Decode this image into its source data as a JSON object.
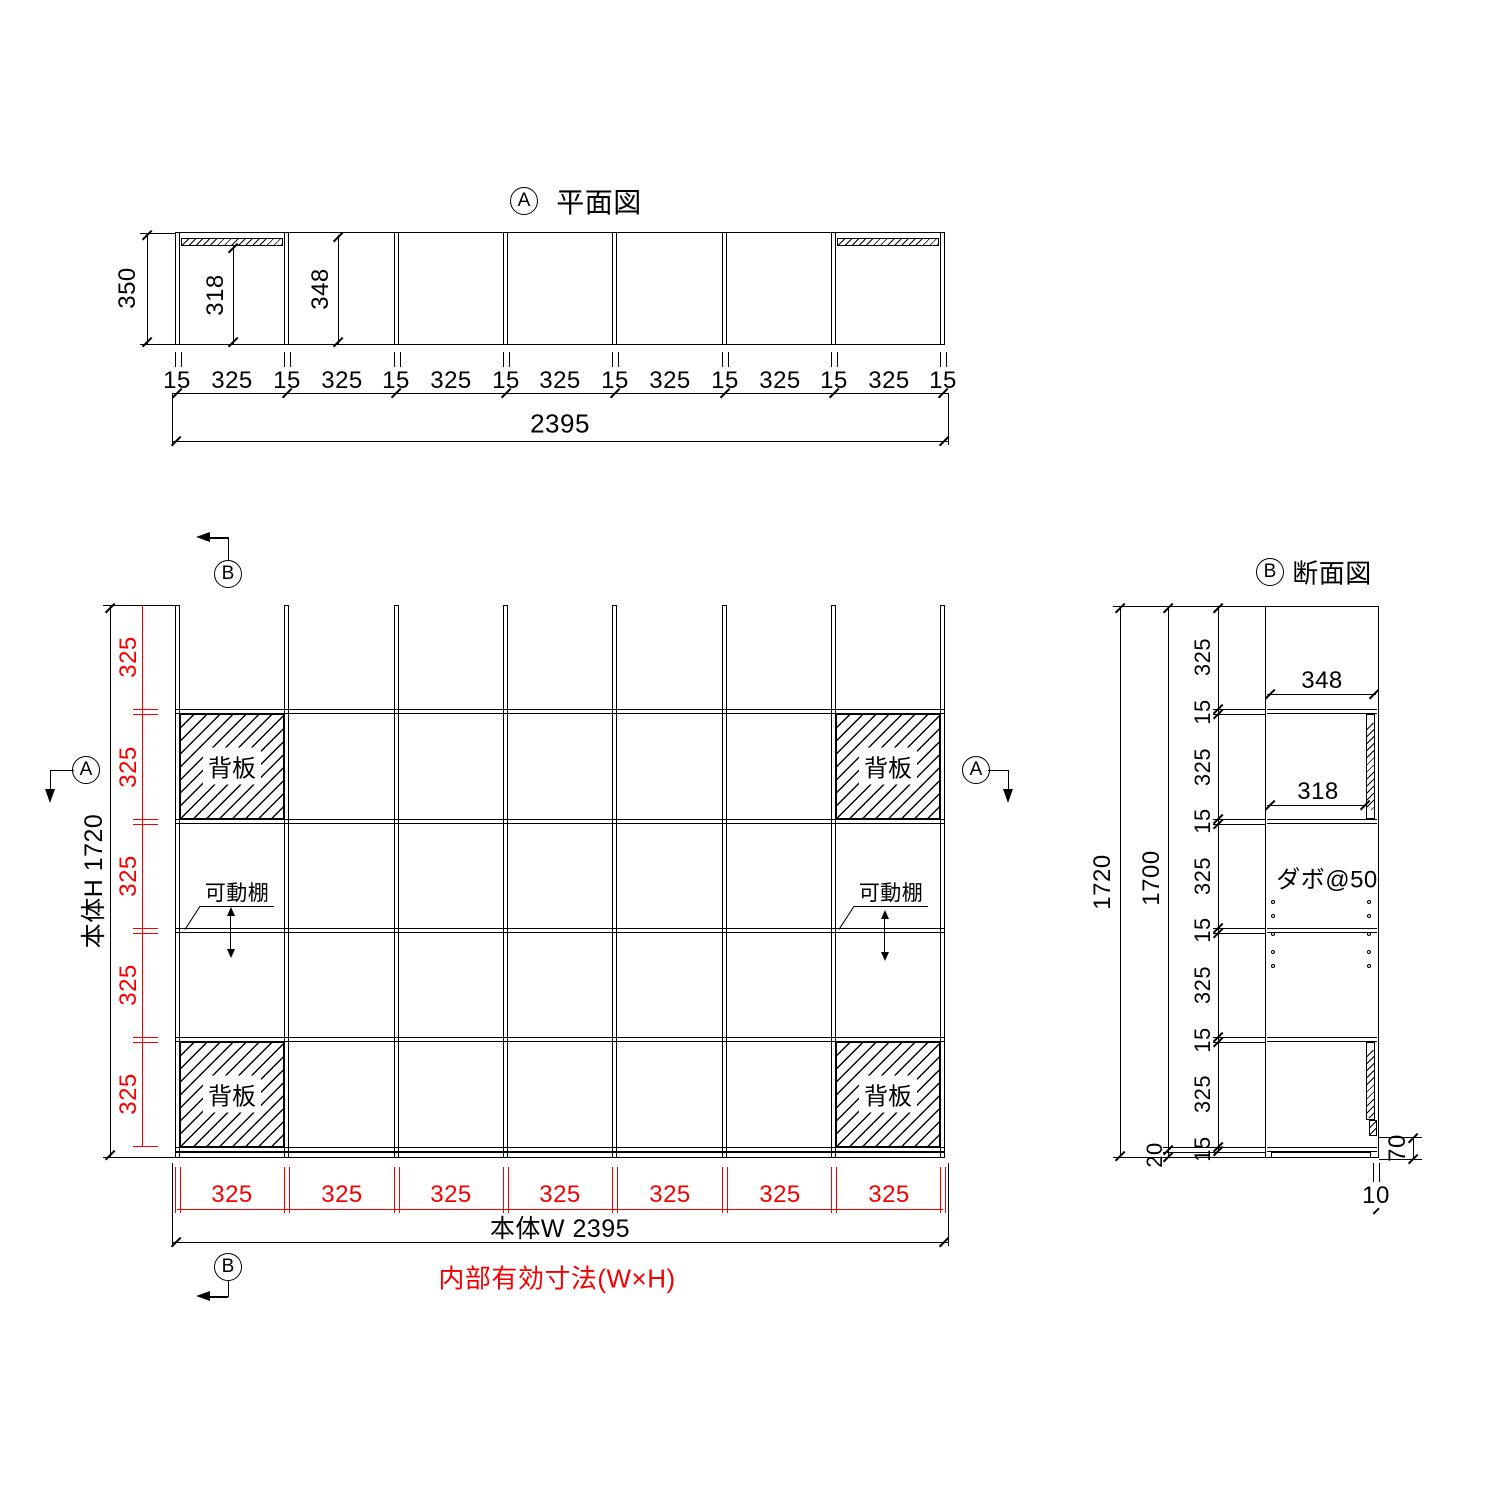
{
  "drawing": {
    "colors": {
      "line": "#000000",
      "dim_accent": "#f40000"
    },
    "plan_view": {
      "marker": "A",
      "title": "平面図",
      "depth": "350",
      "inner_depth_back": "318",
      "inner_depth_open": "348",
      "chain": [
        "15",
        "325",
        "15",
        "325",
        "15",
        "325",
        "15",
        "325",
        "15",
        "325",
        "15",
        "325",
        "15",
        "325",
        "15"
      ],
      "overall": "2395"
    },
    "front_view": {
      "marker_a": "A",
      "marker_b": "B",
      "back_panel": "背板",
      "movable_shelf": "可動棚",
      "height_chain": [
        "325",
        "325",
        "325",
        "325",
        "325"
      ],
      "height_overall": "本体H 1720",
      "width_chain": [
        "325",
        "325",
        "325",
        "325",
        "325",
        "325",
        "325"
      ],
      "width_overall": "本体W 2395",
      "caption": "内部有効寸法(W×H)"
    },
    "section_view": {
      "marker": "B",
      "title": "断面図",
      "overall_height": "1720",
      "inner_height": "1700",
      "depth_open": "348",
      "depth_back": "318",
      "dowel_pitch": "ダボ@50",
      "chain": [
        "325",
        "15",
        "325",
        "15",
        "325",
        "15",
        "325",
        "15",
        "325",
        "15"
      ],
      "base_height": "20",
      "back_panel_gap": "70",
      "base_setback": "10"
    }
  }
}
